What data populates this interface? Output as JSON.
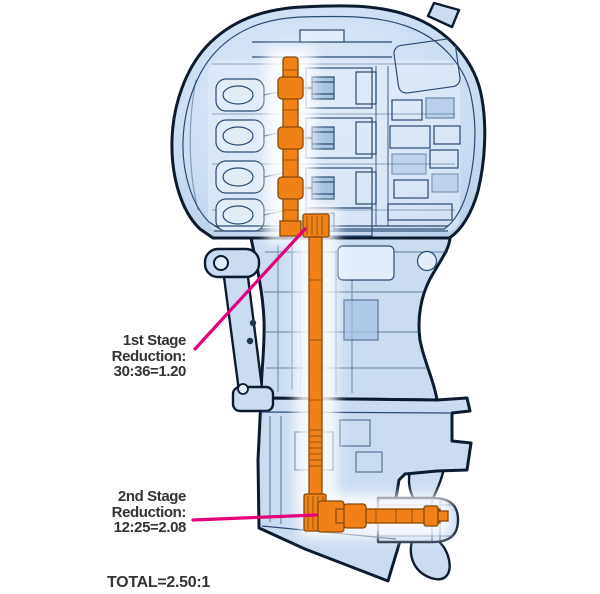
{
  "labels": {
    "stage1": {
      "line1": "1st Stage",
      "line2": "Reduction:",
      "line3": "30:36=1.20"
    },
    "stage2": {
      "line1": "2nd Stage",
      "line2": "Reduction:",
      "line3": "12:25=2.08"
    },
    "total": "TOTAL=2.50:1"
  },
  "highlighted_parts": [
    "crankshaft",
    "driveshaft",
    "propeller-shaft"
  ],
  "colors": {
    "background": "#ffffff",
    "body_fill": "#cbdcf1",
    "body_fill_light": "#e3edf9",
    "body_shade": "#a6c2e2",
    "line_blue": "#2a4a73",
    "outline_dark": "#0d1b2e",
    "highlight_orange": "#f08116",
    "orange_dark": "#8a4a08",
    "callout_magenta": "#e4007c",
    "label_text": "#333333"
  }
}
